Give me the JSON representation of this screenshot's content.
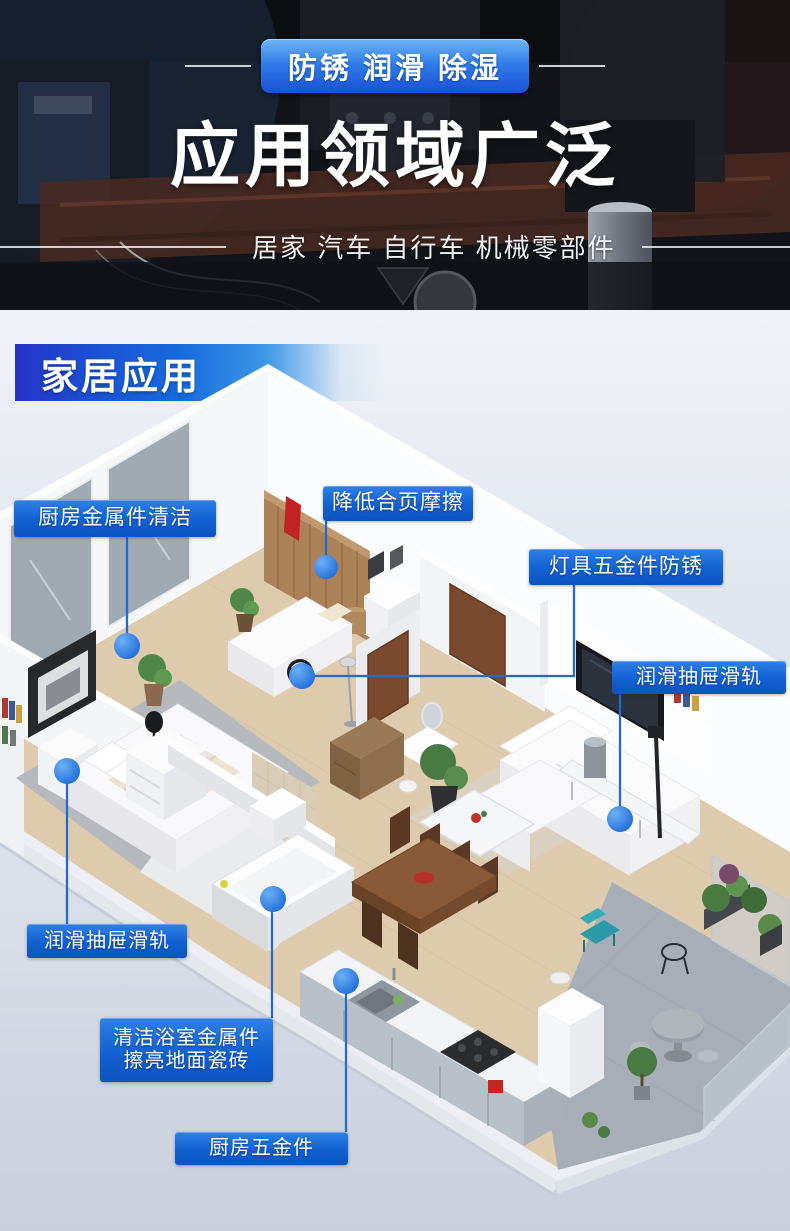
{
  "hero": {
    "badge": "防锈 润滑 除湿",
    "title": "应用领域广泛",
    "subtitle": "居家 汽车 自行车 机械零部件"
  },
  "section": {
    "ribbon": "家居应用"
  },
  "callouts": [
    {
      "id": "kitchen-metal-clean",
      "label": "厨房金属件清洁"
    },
    {
      "id": "hinge-friction",
      "label": "降低合页摩擦"
    },
    {
      "id": "lamp-hardware-rustproof",
      "label": "灯具五金件防锈"
    },
    {
      "id": "drawer-slides-right",
      "label": "润滑抽屉滑轨"
    },
    {
      "id": "drawer-slides-left",
      "label": "润滑抽屉滑轨"
    },
    {
      "id": "bathroom-clean",
      "line1": "清洁浴室金属件",
      "line2": "擦亮地面瓷砖"
    },
    {
      "id": "kitchen-hardware",
      "label": "厨房五金件"
    }
  ],
  "colors": {
    "accent_blue": "#1261d2",
    "dot_blue": "#2e7fe4",
    "line_blue": "#2468d0",
    "ribbon_deep_blue": "#2633c8",
    "badge_blue_top": "#6db5f5",
    "badge_blue_bottom": "#1b51d6"
  }
}
